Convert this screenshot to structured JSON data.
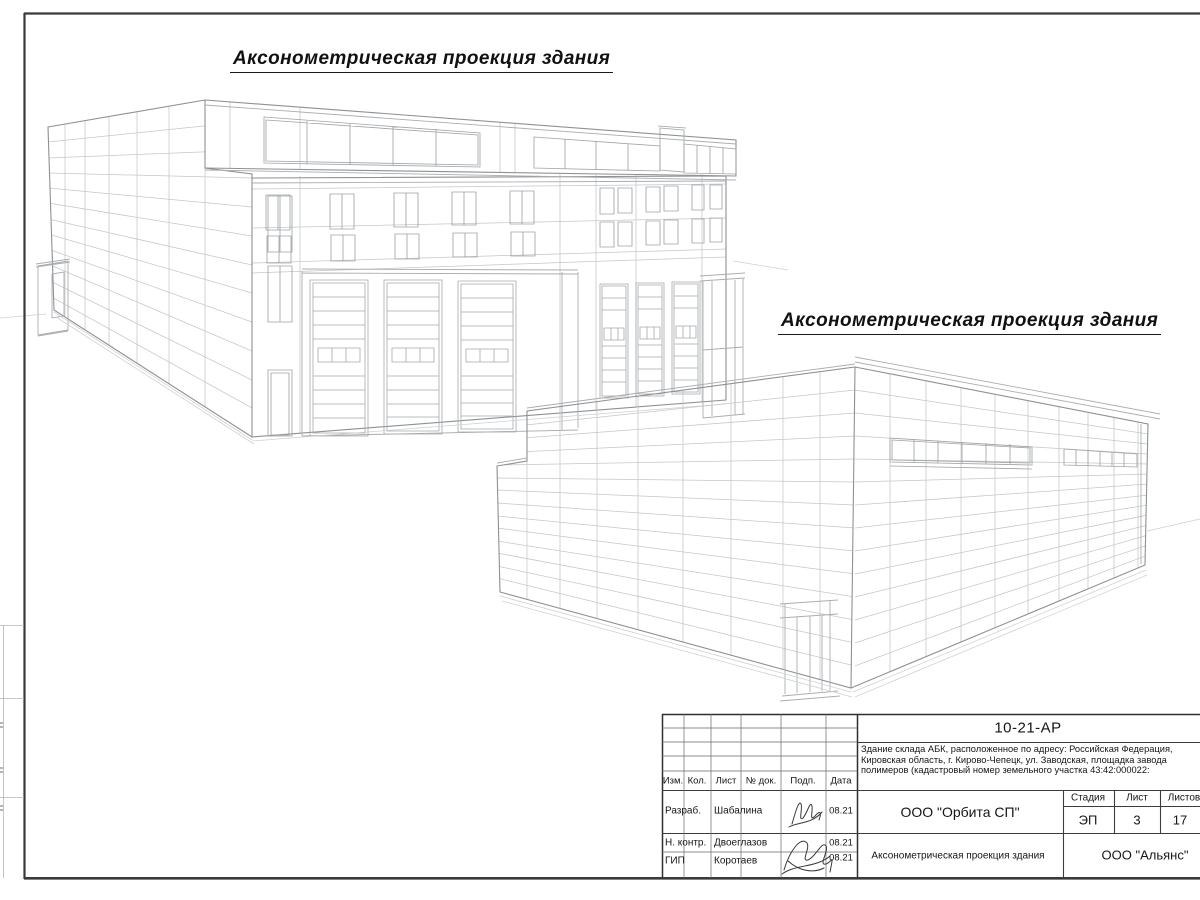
{
  "drawing_titles": {
    "left": "Аксонометрическая проекция здания",
    "right": "Аксонометрическая проекция здания"
  },
  "title_block": {
    "doc_number": "10-21-АР",
    "description_lines": [
      "Здание склада АБК, расположенное по адресу: Российская Федерация,",
      "Кировская область, г. Кирово-Чепецк, ул. Заводская, площадка завода",
      "полимеров (кадастровый номер земельного участка 43:42:000022:"
    ],
    "change_table": {
      "izm": "Изм.",
      "kol": "Кол.",
      "list": "Лист",
      "doc": "№ док.",
      "podp": "Подп.",
      "data": "Дата"
    },
    "rows": [
      {
        "role": "Разраб.",
        "name": "Шабалина",
        "date": "08.21"
      },
      {
        "role": "Н. контр.",
        "name": "Двоеглазов",
        "date": "08.21"
      },
      {
        "role": "ГИП",
        "name": "Коротаев",
        "date": "08.21"
      }
    ],
    "company": "ООО \"Орбита СП\"",
    "stage_label": "Стадия",
    "sheet_label": "Лист",
    "sheets_label": "Листов",
    "stage": "ЭП",
    "sheet_number": "3",
    "sheets_total": "17",
    "sheet_title": "Аксонометрическая проекция здания",
    "contractor": "ООО \"Альянс\""
  }
}
